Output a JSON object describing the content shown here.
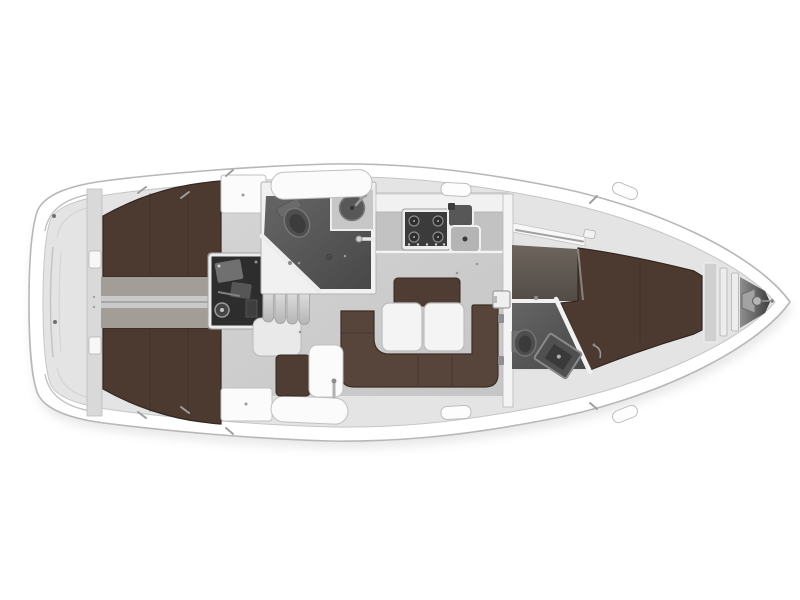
{
  "plan": {
    "type": "sailing-yacht-interior-layout-plan",
    "view": "top-down",
    "bow_direction": "right",
    "regions": [
      "hull",
      "side-deck",
      "transom",
      "stern-bulkhead",
      "port-aft-cabin-berth",
      "starboard-aft-cabin-berth",
      "aft-cabin-passage",
      "engine-compartment",
      "companionway-steps",
      "companionway-landing",
      "aft-head",
      "aft-head-toilet",
      "aft-head-sink",
      "shower",
      "galley",
      "galley-stove",
      "galley-sink",
      "saloon",
      "saloon-settee",
      "saloon-backrest",
      "saloon-table",
      "nav-seat",
      "side-table",
      "main-bulkhead",
      "mast-step",
      "forward-head",
      "forward-head-toilet",
      "forward-head-sink",
      "forward-cabin",
      "forward-berth",
      "hanging-shelf",
      "anchor-locker",
      "windlass",
      "bow"
    ]
  },
  "colors": {
    "background": "#ffffff",
    "hull": "#ffffff",
    "hull-outline": "#b7b7b7",
    "deck": "#e4e4e4",
    "deck-edge": "#c6c6c6",
    "cabin-floor": "#cdcdcd",
    "berth-wood": "#4c3a31",
    "berth-edge": "#34281f",
    "settee": "#57443a",
    "backrest": "#4f3d33",
    "walkway": "#a39d97",
    "head-floor": "#545454",
    "fwd-floor": "#625a54",
    "engine": "#2d2d2d",
    "furniture-white": "#f5f5f5",
    "fixture-gray": "#585858",
    "metal": "#9e9e9e"
  }
}
